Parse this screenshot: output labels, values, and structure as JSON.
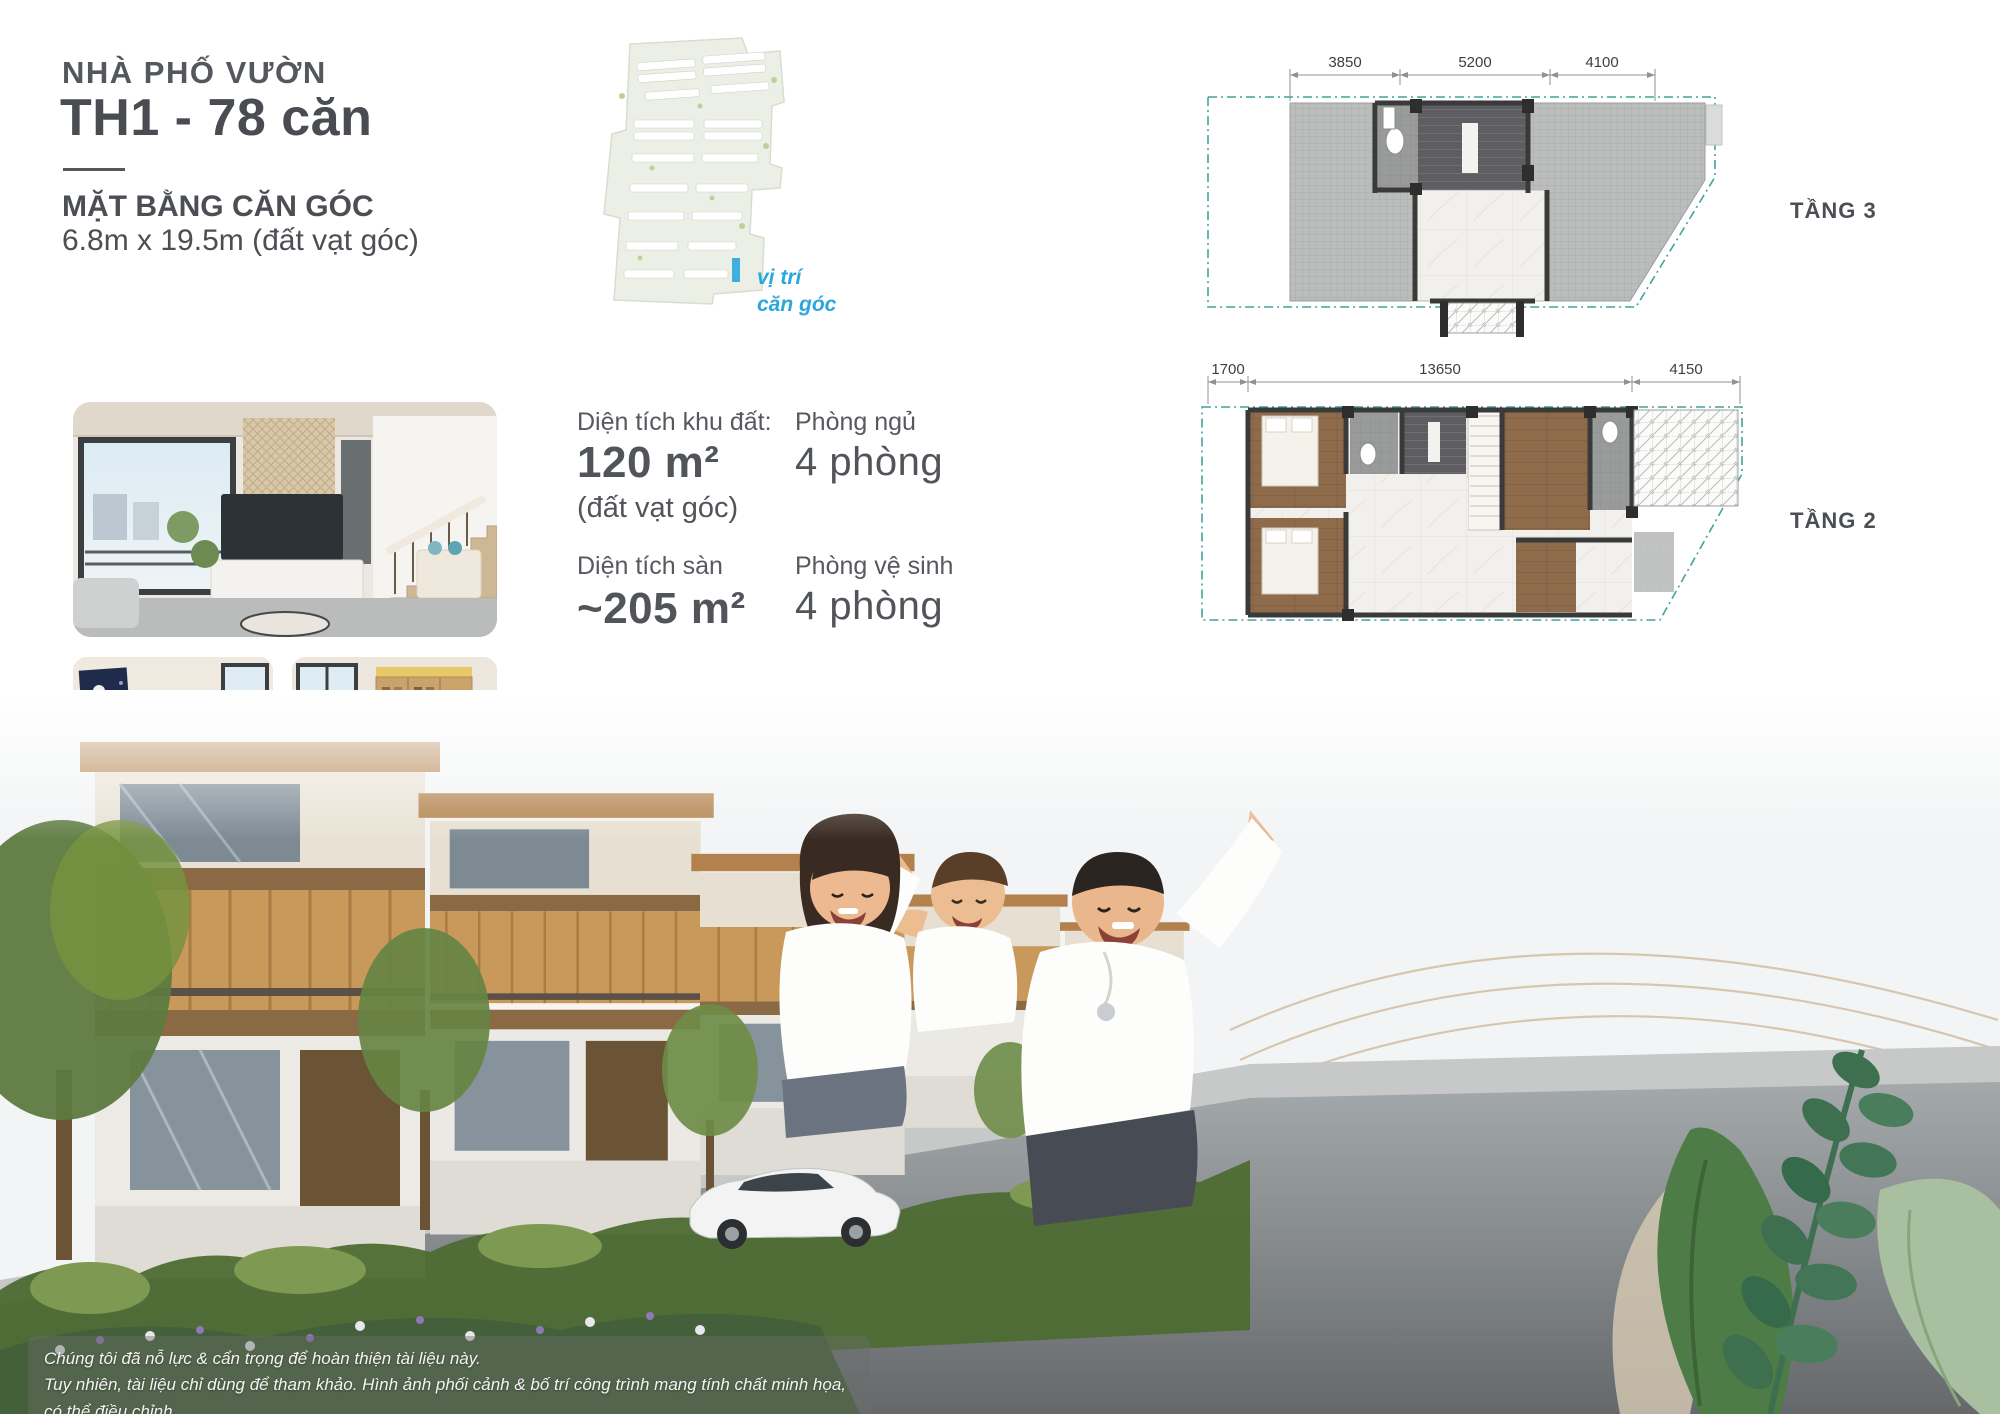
{
  "header": {
    "category": "NHÀ PHỐ VƯỜN",
    "title": "TH1 - 78 căn",
    "subtitle": "MẶT BẰNG CĂN GÓC",
    "dimensions": "6.8m x 19.5m (đất vạt góc)"
  },
  "site_map": {
    "label_line1": "vị trí",
    "label_line2": "căn góc",
    "marker_color": "#2aa7db"
  },
  "stats": [
    {
      "label": "Diện tích khu đất:",
      "value": "120 m²",
      "note": "(đất vạt góc)"
    },
    {
      "label": "Phòng ngủ",
      "value": "4 phòng"
    },
    {
      "label": "Diện tích sàn",
      "value": "~205 m²"
    },
    {
      "label": "Phòng vệ sinh",
      "value": "4 phòng"
    }
  ],
  "floor_plans": [
    {
      "label": "TẦNG 3",
      "dims_top": [
        "3850",
        "5200",
        "4100"
      ]
    },
    {
      "label": "TẦNG 2",
      "dims_top": [
        "1700",
        "13650",
        "4150"
      ]
    },
    {
      "label": "TẦNG 1",
      "dim_left": "6800",
      "dim_bottom": "19500",
      "entrance": "Lối vào"
    }
  ],
  "disclaimer": {
    "line1": "Chúng tôi đã nỗ lực & cẩn trọng để hoàn thiện tài liệu này.",
    "line2": "Tuy nhiên, tài liệu chỉ dùng để tham khảo. Hình ảnh phối cảnh & bố trí công trình mang tính chất minh họa, có thể điều chỉnh.",
    "line3": "Thông tin chính thức được căn cứ trên hợp đồng mua bán."
  },
  "colors": {
    "accent_teal_boundary": "#41a39b",
    "accent_cyan": "#2aa7db",
    "heading_gray": "#4b4e53",
    "deck_gray": "#babdbb",
    "wood": "#8d6b4b",
    "lawn_green": "#9ab172"
  }
}
